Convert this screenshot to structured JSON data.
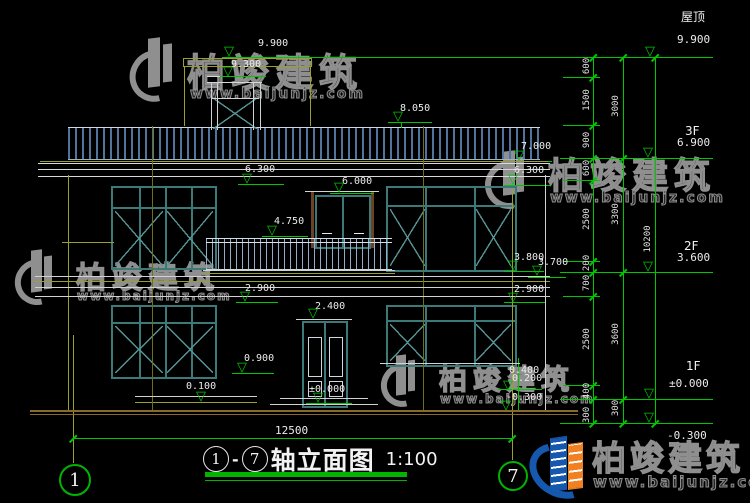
{
  "watermark": {
    "brand": "柏竣建筑",
    "url": "www.baijunjz.com"
  },
  "drawing": {
    "title": "轴立面图",
    "axis_start": "1",
    "axis_end": "7",
    "dash": "-",
    "scale": "1:100",
    "overall_width": "12500"
  },
  "floor_levels": {
    "roof_label": "屋顶",
    "roof": "9.900",
    "f3_label": "3F",
    "f3": "6.900",
    "f2_label": "2F",
    "f2": "3.600",
    "f1_label": "1F",
    "f1": "±0.000",
    "ground": "-0.300"
  },
  "elevation_marks": {
    "roof_top": "9.900",
    "chimney_cap": "9.300",
    "roof_deck": "8.050",
    "eave_top": "7.000",
    "eave_bottom_right": "6.300",
    "eave_bottom_left": "6.300",
    "balcony_door_head": "6.000",
    "balcony_rail": "4.750",
    "sill_right": "3.800",
    "balcony_floor": "3.700",
    "beam_bottom_right": "2.900",
    "beam_bottom_left": "2.900",
    "entry_door_head": "2.400",
    "window_sill": "0.900",
    "step_top": "0.100",
    "entry_floor": "±0.000",
    "porch_upper": "0.400",
    "porch_lower": "0.200",
    "ground_right": "-0.300"
  },
  "dimensions": {
    "col1": [
      "600",
      "1500",
      "900",
      "600",
      "2500",
      "200",
      "700",
      "2500",
      "400",
      "300"
    ],
    "col2": [
      "3000",
      "3300",
      "3600",
      "300"
    ],
    "col3": [
      "10200"
    ]
  }
}
